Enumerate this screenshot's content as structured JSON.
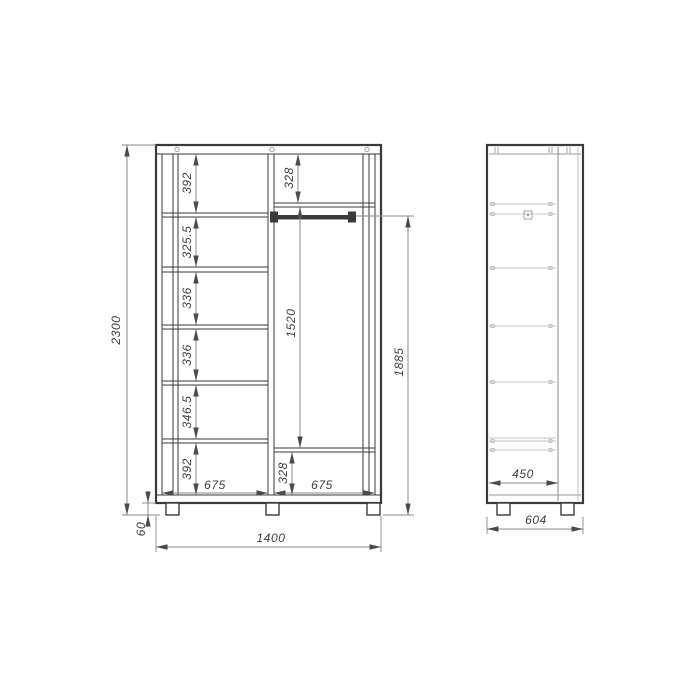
{
  "front_view": {
    "overall_height": "2300",
    "base_height": "60",
    "overall_width": "1400",
    "left_column": {
      "width": "675",
      "compartments": [
        "392",
        "325.5",
        "336",
        "336",
        "346.5",
        "392"
      ]
    },
    "right_column": {
      "width": "675",
      "top_shelf": "328",
      "hanging_space": "1520",
      "bottom_space": "328",
      "rod_to_floor": "1885"
    }
  },
  "side_view": {
    "usable_depth": "450",
    "overall_depth": "604"
  }
}
